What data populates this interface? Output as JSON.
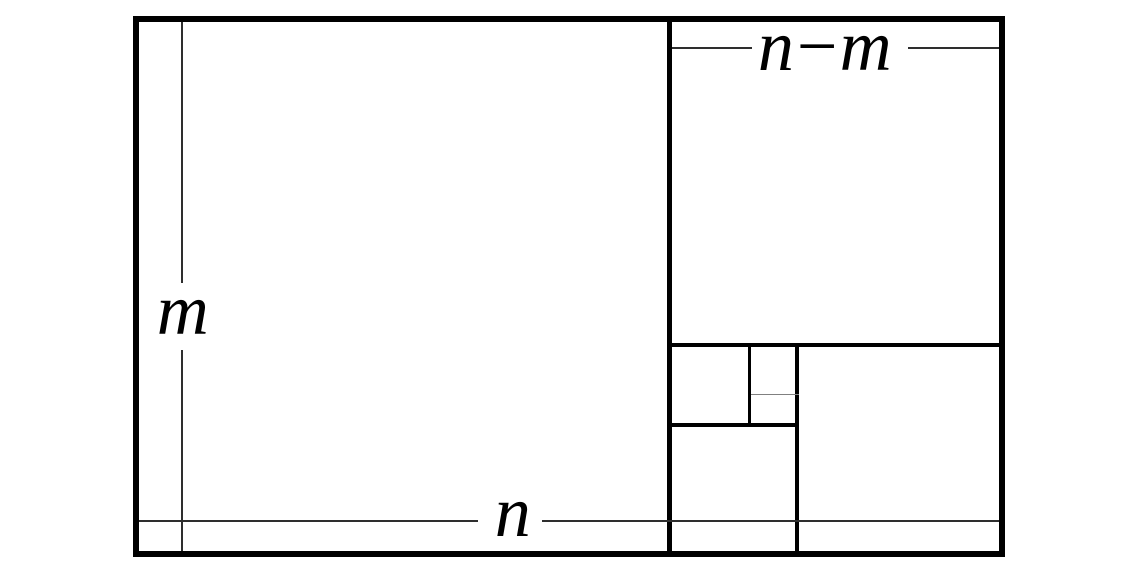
{
  "figure": {
    "type": "geometric-diagram",
    "description": "Rectangle with sides n and m recursively subdivided into squares (golden-ratio / Euclidean algorithm illustration)",
    "labels": {
      "height": "m",
      "width": "n",
      "difference": "n−m"
    },
    "colors": {
      "line": "#000000",
      "measure_line": "#2e2e2e",
      "background": "#ffffff"
    }
  }
}
